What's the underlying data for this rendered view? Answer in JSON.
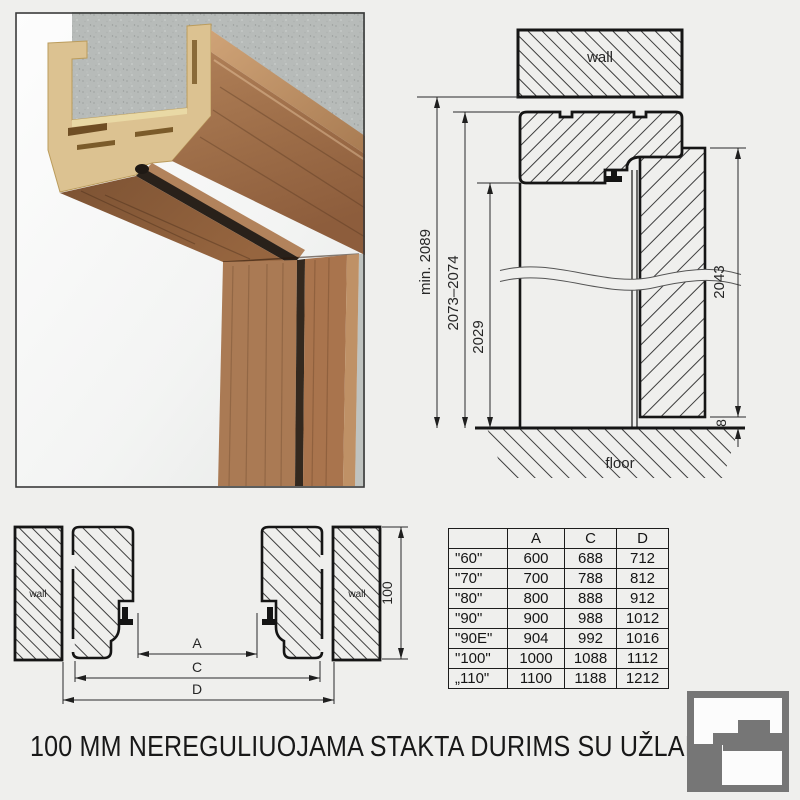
{
  "page": {
    "background": "#efefed",
    "title": "100 MM NEREGULIUOJAMA STAKTA DURIMS SU UŽLAIDA"
  },
  "vertical_section": {
    "wall_label": "wall",
    "floor_label": "floor",
    "dims": {
      "min_total_height": "min. 2089",
      "frame_outer_height": "2073–2074",
      "clear_opening_height": "2029",
      "door_leaf_height": "2043",
      "floor_gap": "8"
    }
  },
  "horizontal_section": {
    "left_wall_label": "wall",
    "right_wall_label": "wall",
    "dims": {
      "clear_width": "A",
      "frame_outer_width": "C",
      "wall_opening_width": "D",
      "frame_depth": "100"
    }
  },
  "size_table": {
    "headers": [
      "",
      "A",
      "C",
      "D"
    ],
    "rows": [
      [
        "\"60\"",
        "600",
        "688",
        "712"
      ],
      [
        "\"70\"",
        "700",
        "788",
        "812"
      ],
      [
        "\"80\"",
        "800",
        "888",
        "912"
      ],
      [
        "\"90\"",
        "900",
        "988",
        "1012"
      ],
      [
        "\"90E\"",
        "904",
        "992",
        "1016"
      ],
      [
        "\"100\"",
        "1000",
        "1088",
        "1112"
      ],
      [
        "„110\"",
        "1100",
        "1188",
        "1212"
      ]
    ]
  },
  "colors": {
    "line": "#1a1a1a",
    "hatch": "#3d3d3d",
    "wood_front": "#a9744d",
    "wood_light": "#c89c70",
    "wood_dark": "#7f5536",
    "mdf": "#dcc291",
    "concrete": "#b7bbb9",
    "gasket": "#29211a",
    "logo_gray": "#767676"
  }
}
